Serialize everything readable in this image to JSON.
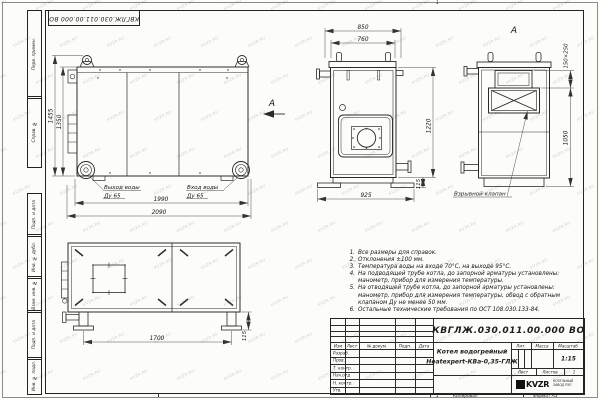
{
  "watermark": {
    "text": "KVZR.RU"
  },
  "frame": {
    "top_stamp": "КВГЛЖ.030.011.00.000 ВО",
    "margin_labels": [
      "Перв. примен.",
      "Справ. №",
      "Подп. и дата",
      "Инв. № дубл.",
      "Взам. инв. №",
      "Подп. и дата",
      "Инв. № подл."
    ],
    "fold_mark": "1",
    "bottom": {
      "copy_num": "1",
      "copied": "Копировал",
      "format": "Формат А3"
    }
  },
  "views": {
    "side": {
      "view_label": "А",
      "dim_height_outer": "1455",
      "dim_height_inner": "1350",
      "dim_len_inner": "1990",
      "dim_len_outer": "2090",
      "outlet_line1": "Выход воды",
      "outlet_line2": "Ду 65",
      "inlet_line1": "Вход воды",
      "inlet_line2": "Ду 65"
    },
    "front": {
      "dim_width_outer": "850",
      "dim_width_inner": "760",
      "dim_height": "1220",
      "dim_base": "925",
      "dim_foot": "115"
    },
    "section": {
      "view_label": "А",
      "dim_valve": "150×250",
      "dim_height": "1050",
      "valve_label": "Взрывной клапан"
    },
    "plan": {
      "dim_legs": "1700",
      "dim_offset": "115"
    }
  },
  "notes": {
    "items": [
      {
        "n": "1.",
        "t": "Все размеры для справок."
      },
      {
        "n": "2.",
        "t": "Отклонения ±100 мм."
      },
      {
        "n": "3.",
        "t": "Температура воды на входе 70°С, на выходе 95°С."
      },
      {
        "n": "4.",
        "t": "На подводящей трубе котла, до запорной арматуры установлены: манометр, прибор для измерения температуры."
      },
      {
        "n": "5.",
        "t": "На отводящей трубе котла, до запорной арматуры установлены: манометр, прибор для измерения температуры, обвод с обратным клапаном Ду не менее 50 мм."
      },
      {
        "n": "6.",
        "t": "Остальные технические требования по ОСТ 108.030.133-84."
      }
    ]
  },
  "title_block": {
    "designation": "КВГЛЖ.030.011.00.000 ВО",
    "name_line1": "Котел водогрейный",
    "name_line2": "Heatexpert-КВа-0,35-ГЛЖ",
    "cols": [
      "Изм",
      "Лист",
      "№ докум.",
      "Подп.",
      "Дата"
    ],
    "rows": [
      "Разраб.",
      "Пров.",
      "Т. контр.",
      "Нач.отд",
      "Н. контр.",
      "Утв."
    ],
    "lit": "Лит.",
    "mass": "Масса",
    "scale": "Масштаб",
    "scale_value": "1:15",
    "sheet": "Лист",
    "sheets": "Листов",
    "sheets_value": "1",
    "logo": "KVZR",
    "company_line1": "КОТЕЛЬНЫЙ",
    "company_line2": "ЗАВОД РЭП"
  }
}
